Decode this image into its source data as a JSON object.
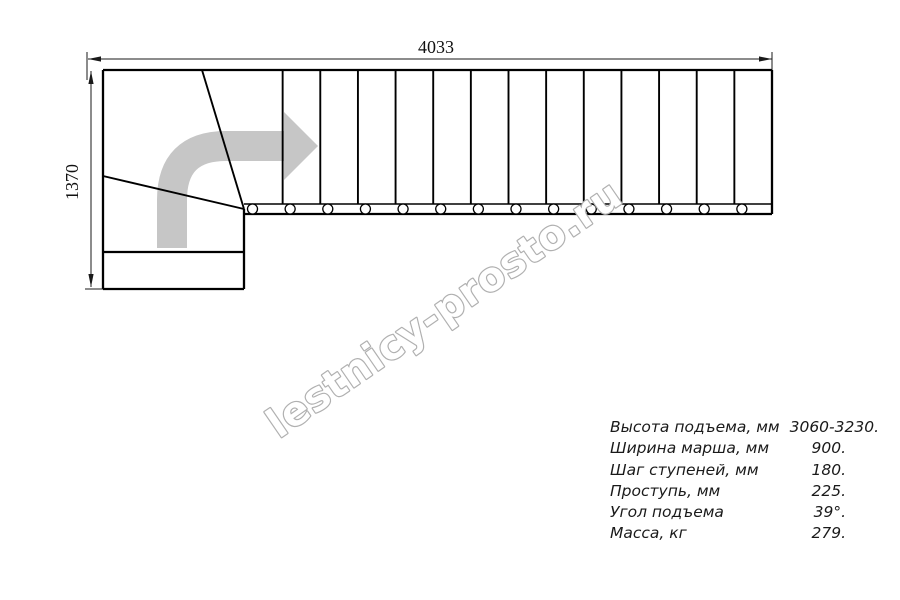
{
  "dimensions": {
    "top": "4033",
    "left": "1370"
  },
  "watermark": "lestnicy-prosto.ru",
  "specs": {
    "rows": [
      {
        "label": "Высота подъема, мм",
        "value": "3060-3230."
      },
      {
        "label": "Ширина марша, мм",
        "value": "900."
      },
      {
        "label": "Шаг ступеней, мм",
        "value": "180."
      },
      {
        "label": "Проступь, мм",
        "value": "225."
      },
      {
        "label": "Угол подъема",
        "value": "39°."
      },
      {
        "label": "Масса, кг",
        "value": "279."
      }
    ]
  },
  "geometry": {
    "flight": {
      "x1": 245,
      "x2": 772,
      "top": 70,
      "band_top": 204,
      "band_bottom": 214,
      "tread_count": 14
    },
    "bolts": {
      "y": 209,
      "r": 5,
      "offset": 7.5
    },
    "landing": {
      "x1": 103,
      "x2": 244,
      "top": 70,
      "bottom": 289,
      "shelf_y": 252
    }
  },
  "colors": {
    "line": "#000000",
    "dimension": "#1a1a1a",
    "direction_arrow": "#c6c6c6",
    "watermark_outline": "#b0b0b0",
    "spec_text": "#1a1a1a"
  }
}
